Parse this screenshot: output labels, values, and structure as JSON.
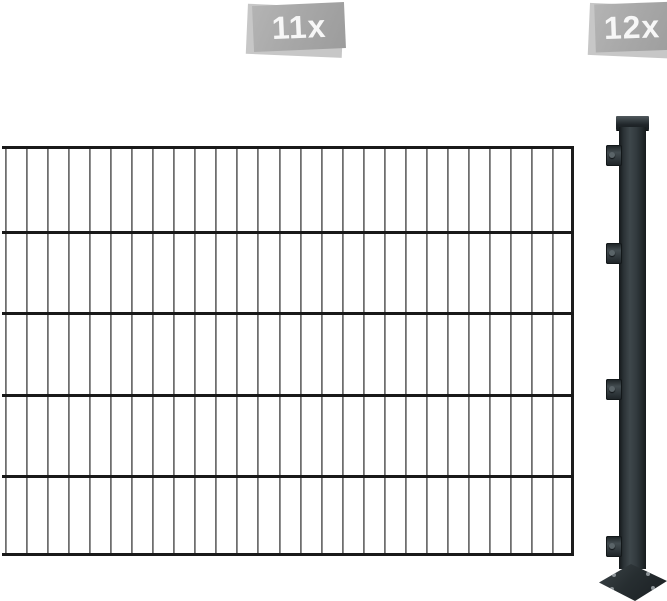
{
  "badges": {
    "panel_count": "11x",
    "post_count": "12x",
    "face_color": "#a8a8a8",
    "edge_color": "#c7c7c7",
    "text_color": "#f7f7f7"
  },
  "fence": {
    "vertical_bars": {
      "count": 27,
      "x_start": 5,
      "spacing": 21.04,
      "top": 146,
      "height": 409,
      "color": "#7d7d7d"
    },
    "edge_bar": {
      "x": 571,
      "top": 146,
      "height": 409,
      "color": "#1d1d1d"
    },
    "horizontal_bars": {
      "count": 6,
      "y_positions": [
        146,
        231,
        312,
        394,
        475,
        553
      ],
      "left": 2,
      "width": 572,
      "color": "#191919"
    }
  },
  "post": {
    "clamp_count": 4,
    "clamp_y_positions": [
      145,
      243,
      379,
      536
    ],
    "body_color": "#343c40",
    "cap_color": "#20262a",
    "base_plate_color": "#272e31"
  }
}
